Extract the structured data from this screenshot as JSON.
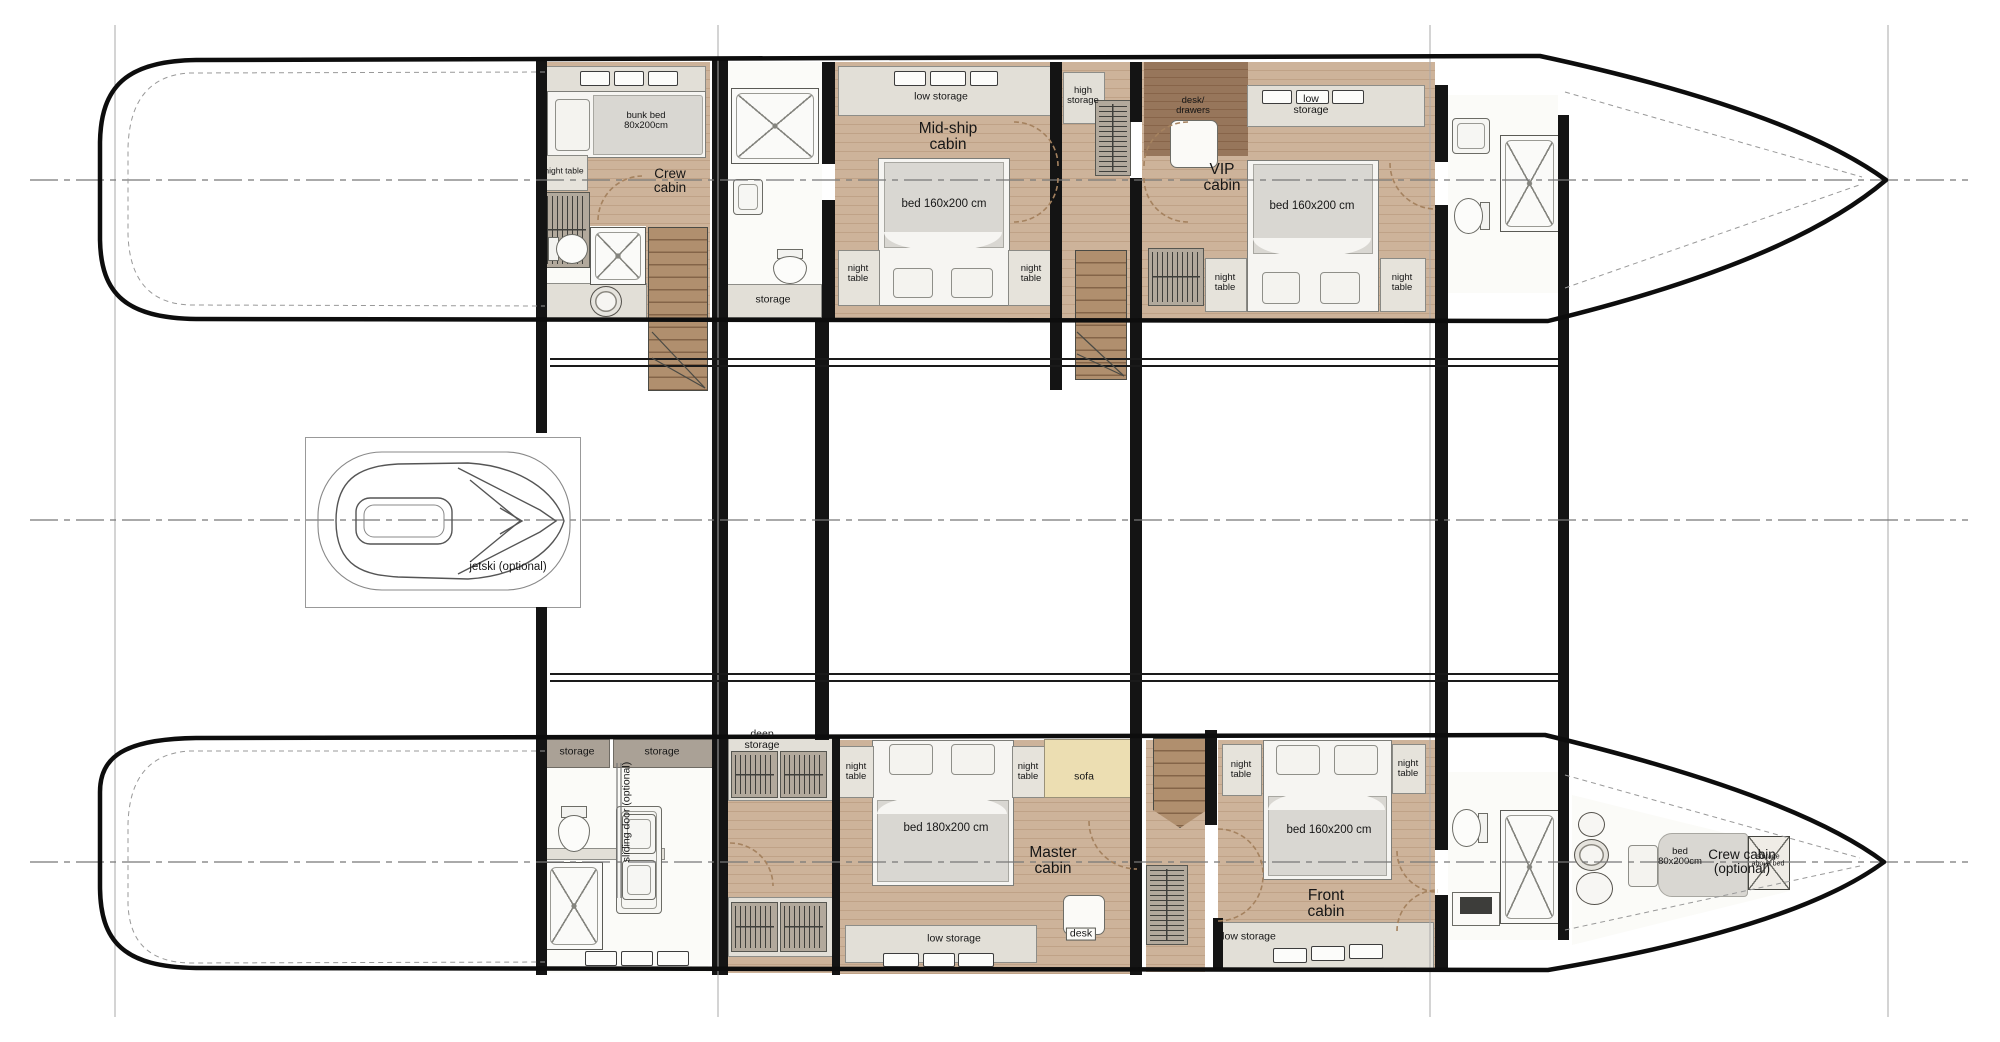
{
  "drawing": {
    "type": "catamaran-deck-plan",
    "hull_count": 2
  },
  "cabins": [
    {
      "name": "Crew cabin",
      "bed": "bunk bed 80x200cm"
    },
    {
      "name": "Mid-ship cabin",
      "bed": "bed 160x200 cm"
    },
    {
      "name": "VIP cabin",
      "bed": "bed 160x200 cm"
    },
    {
      "name": "Master cabin",
      "bed": "bed 180x200 cm"
    },
    {
      "name": "Front cabin",
      "bed": "bed 160x200 cm"
    },
    {
      "name": "Crew cabin (optional)",
      "bed": "bed 80x200cm"
    }
  ],
  "labels": {
    "night_table": "night table",
    "storage": "storage",
    "low_storage": "low storage",
    "high_storage": "high storage",
    "deep_storage": "deep storage",
    "desk_drawers": "desk/ drawers",
    "desk": "desk",
    "sofa": "sofa",
    "jetski": "jetski (optional)",
    "sliding_door": "sliding door (optional)",
    "storage_above_bed": "storage above bed"
  },
  "colors": {
    "wall": "#141414",
    "wood_floor": "#cdb39a",
    "dark_wood_floor": "#97765b",
    "stair_wood": "#b08f6e",
    "bed_gray": "#d9d7d2",
    "storage_gray": "#aaa196",
    "strip_gray": "#e2dfd7",
    "sofa_beige": "#ecdeb2",
    "door_arc": "#a5825f",
    "centerline": "#777777"
  }
}
